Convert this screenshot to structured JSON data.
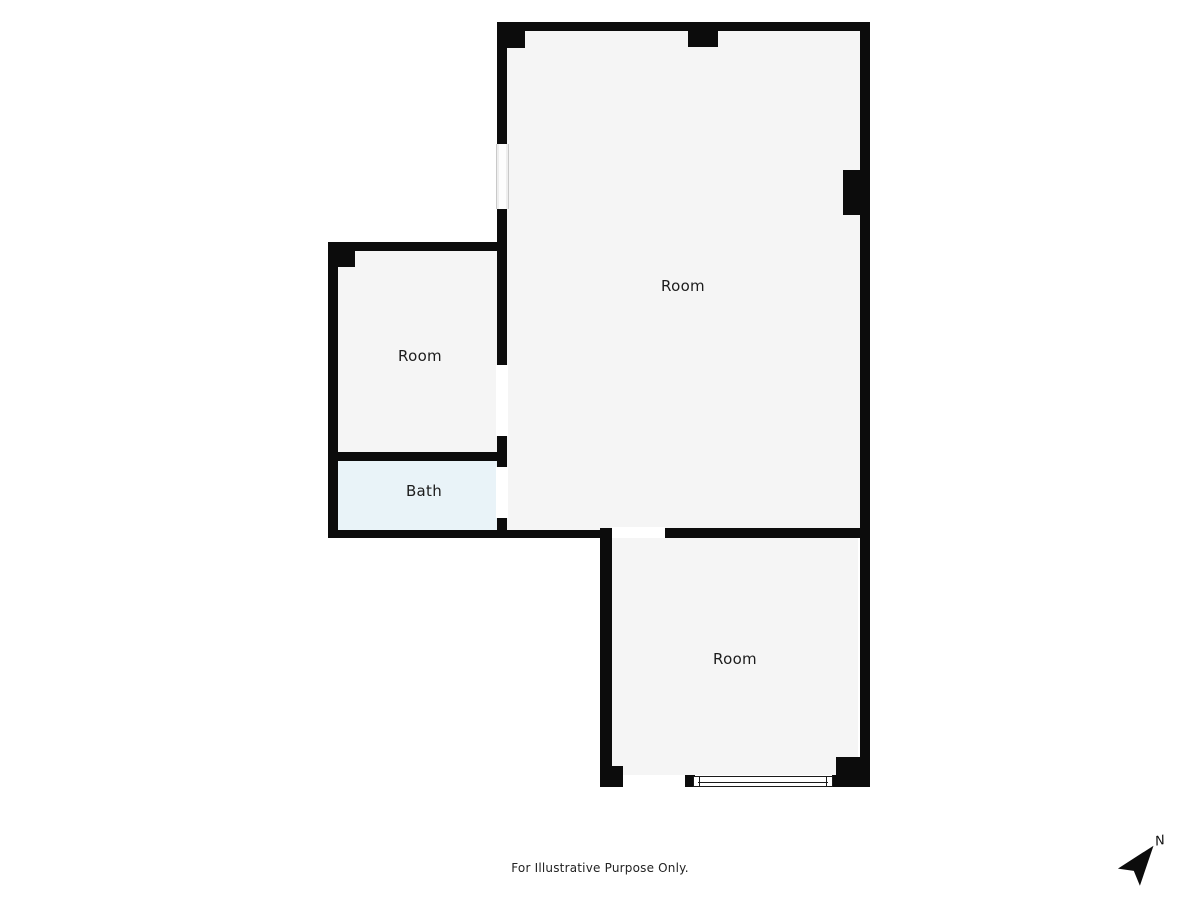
{
  "plan": {
    "title": "Floor plan",
    "rooms": [
      {
        "id": "room-top-right",
        "label": "Room"
      },
      {
        "id": "room-left",
        "label": "Room"
      },
      {
        "id": "bath",
        "label": "Bath"
      },
      {
        "id": "room-bottom",
        "label": "Room"
      }
    ]
  },
  "footer": {
    "disclaimer": "For Illustrative Purpose Only."
  },
  "compass": {
    "label": "N",
    "direction": "north-east"
  },
  "colors": {
    "wall": "#0c0c0c",
    "floor": "#f5f5f5",
    "bath_floor": "#e9f3f8",
    "background": "#ffffff",
    "label_text": "#1c1c1c"
  }
}
